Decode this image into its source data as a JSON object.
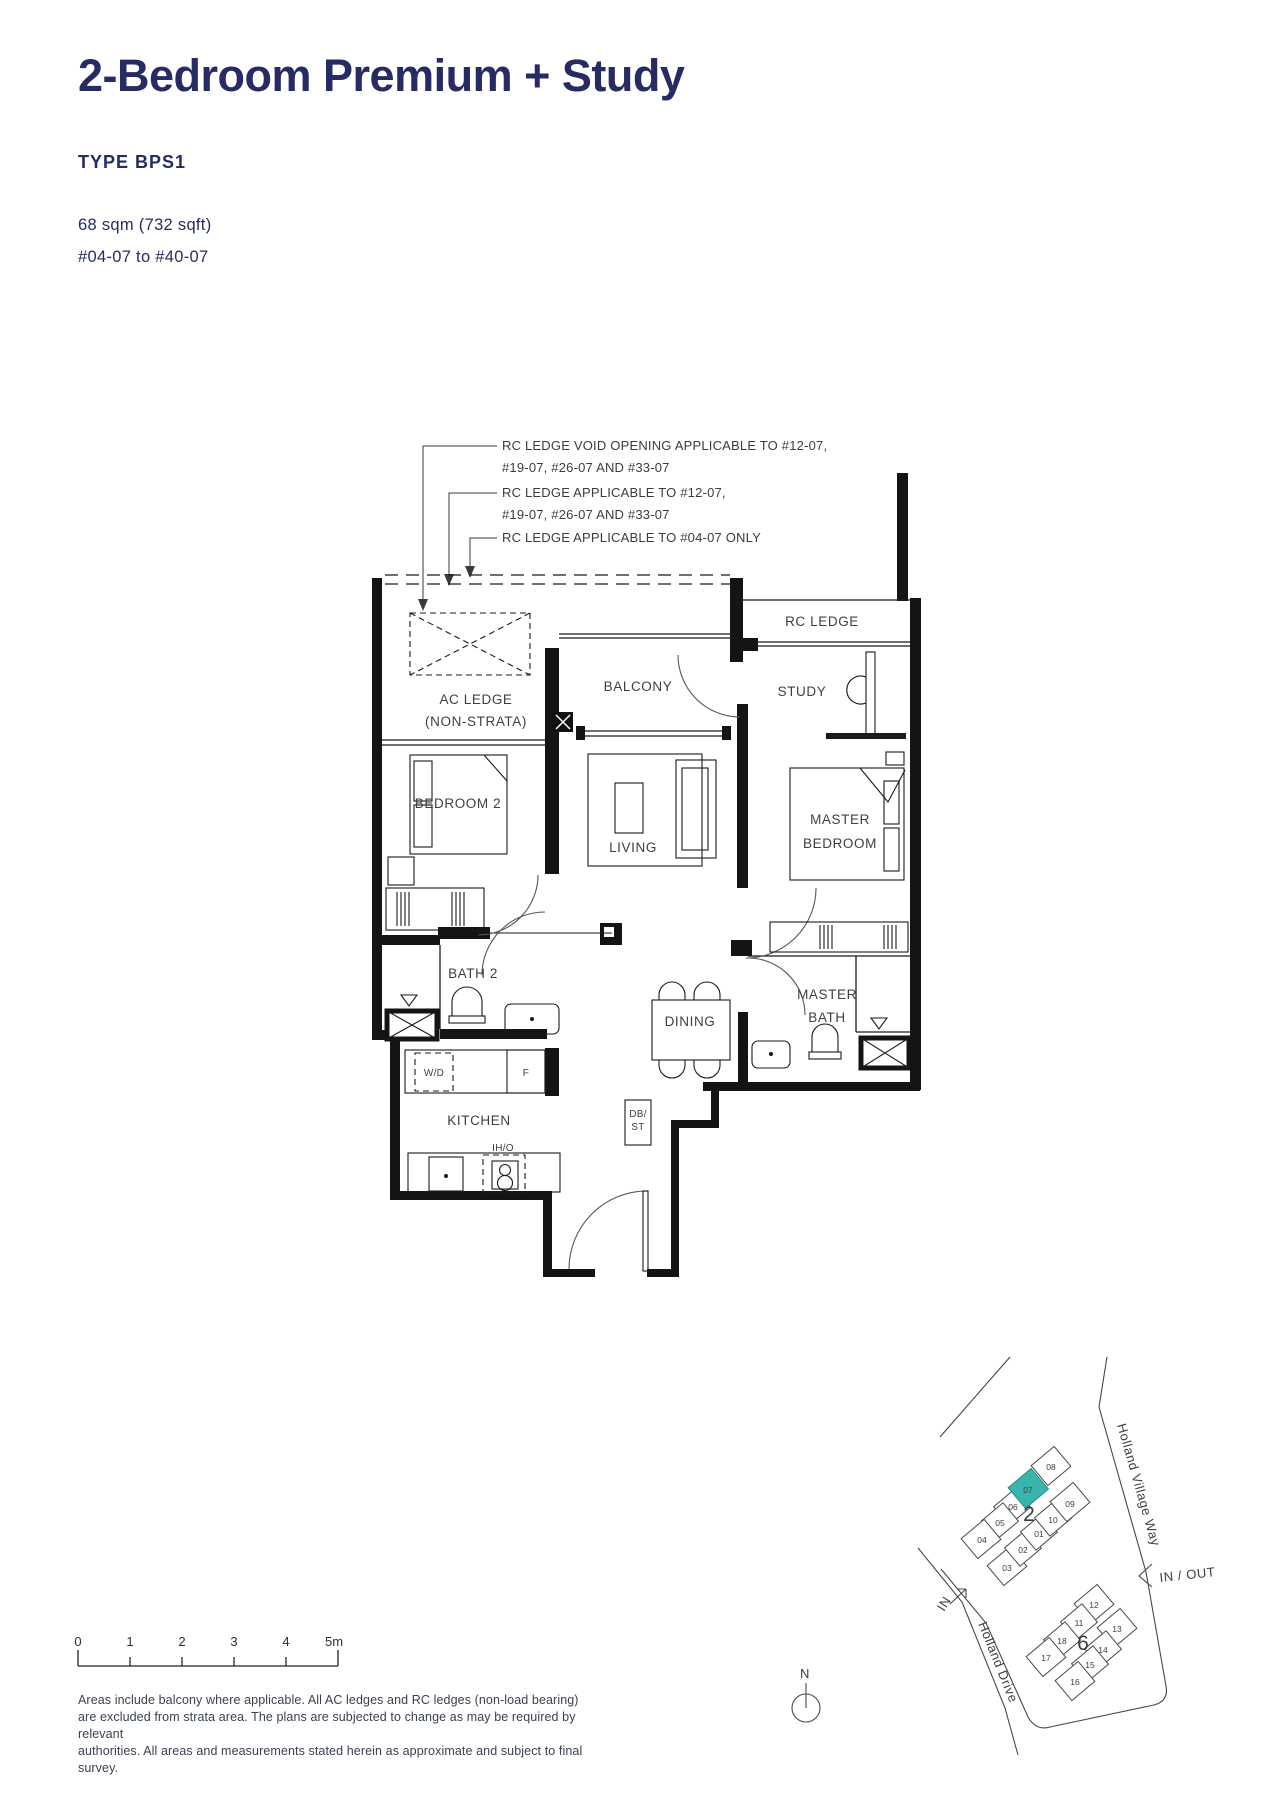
{
  "header": {
    "title": "2-Bedroom Premium + Study",
    "type_label": "TYPE BPS1",
    "area": "68 sqm (732 sqft)",
    "units": "#04-07 to #40-07"
  },
  "annotations": {
    "a1_line1": "RC LEDGE VOID OPENING APPLICABLE TO #12-07,",
    "a1_line2": "#19-07, #26-07 AND #33-07",
    "a2_line1": "RC LEDGE APPLICABLE TO #12-07,",
    "a2_line2": "#19-07, #26-07 AND #33-07",
    "a3_line1": "RC LEDGE APPLICABLE TO #04-07 ONLY"
  },
  "rooms": {
    "ac_ledge_line1": "AC LEDGE",
    "ac_ledge_line2": "(NON-STRATA)",
    "balcony": "BALCONY",
    "rc_ledge": "RC LEDGE",
    "study": "STUDY",
    "bedroom2": "BEDROOM 2",
    "living": "LIVING",
    "master_bedroom_line1": "MASTER",
    "master_bedroom_line2": "BEDROOM",
    "bath2": "BATH 2",
    "dining": "DINING",
    "master_bath_line1": "MASTER",
    "master_bath_line2": "BATH",
    "kitchen": "KITCHEN",
    "wd": "W/D",
    "fridge": "F",
    "dbst_line1": "DB/",
    "dbst_line2": "ST",
    "iho": "IH/O"
  },
  "site_map": {
    "road_1": "Holland Village Way",
    "road_2": "Holland Drive",
    "in_out": "IN / OUT",
    "in_label": "IN",
    "north": "N",
    "block_2": "2",
    "block_6": "6",
    "highlight_color": "#3ab5ae",
    "cluster2_units": [
      "08",
      "07",
      "06",
      "05",
      "04",
      "03",
      "02",
      "01",
      "10",
      "09"
    ],
    "cluster6_units": [
      "12",
      "11",
      "13",
      "18",
      "14",
      "17",
      "15",
      "16"
    ]
  },
  "scale_bar": {
    "labels": [
      "0",
      "1",
      "2",
      "3",
      "4",
      "5m"
    ]
  },
  "disclaimer": {
    "line1": "Areas include balcony where applicable. All AC ledges and RC ledges (non-load bearing)",
    "line2": "are excluded from strata area. The plans are subjected to change as may be required by relevant",
    "line3": "authorities. All areas and measurements stated herein as approximate and subject to final survey."
  },
  "colors": {
    "navy": "#262b63",
    "teal": "#3ab5ae",
    "line": "#1a1a1a"
  }
}
